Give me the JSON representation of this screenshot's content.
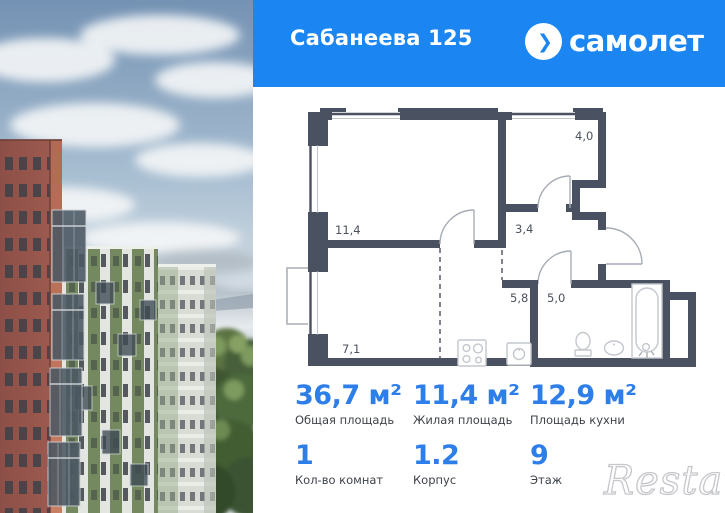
{
  "header": {
    "title": "Сабанеева 125",
    "brand": "самолет",
    "logo_glyph": "❯"
  },
  "floorplan": {
    "rooms": {
      "living": "11,4",
      "storage": "4,0",
      "hall": "3,4",
      "kitchen_nook": "5,8",
      "bathroom": "5,0",
      "kitchen_living": "7,1"
    }
  },
  "stats": {
    "cells": [
      {
        "value": "36,7 м²",
        "label": "Общая площадь"
      },
      {
        "value": "11,4 м²",
        "label": "Жилая площадь"
      },
      {
        "value": "12,9 м²",
        "label": "Площадь кухни"
      },
      {
        "value": "1",
        "label": "Кол-во комнат"
      },
      {
        "value": "1.2",
        "label": "Корпус"
      },
      {
        "value": "9",
        "label": "Этаж"
      }
    ]
  },
  "watermark": "Restate",
  "colors": {
    "header_blue": "#1b86f2",
    "accent_blue": "#2d7ee9",
    "wall": "#4a5160"
  }
}
